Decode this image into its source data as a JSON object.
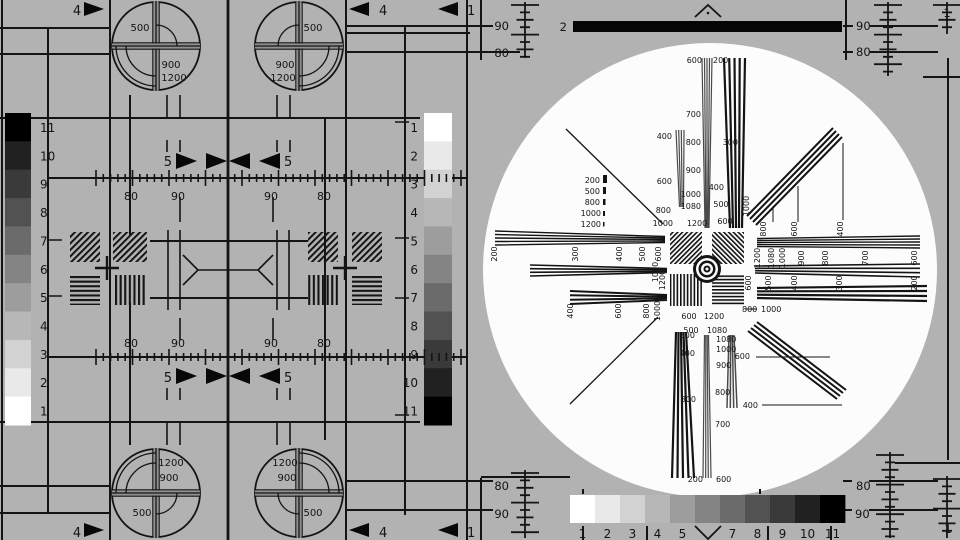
{
  "colors": {
    "background": "#b2b2b2",
    "line": "#141414",
    "white_disc": "#fcfcfc",
    "bar_black": "#050505",
    "gray_fan": "#4a4a4a"
  },
  "grayscale": {
    "steps_light_to_dark": [
      "#ffffff",
      "#e9e9e9",
      "#d2d2d2",
      "#b7b7b7",
      "#9d9d9d",
      "#848484",
      "#6b6b6b",
      "#525252",
      "#3a3a3a",
      "#212121",
      "#000000"
    ],
    "left_labels_top_to_bottom": [
      "11",
      "10",
      "9",
      "8",
      "7",
      "6",
      "5",
      "4",
      "3",
      "2",
      "1"
    ],
    "mid_labels_top_to_bottom": [
      "1",
      "2",
      "3",
      "4",
      "5",
      "6",
      "7",
      "8",
      "9",
      "10",
      "11"
    ],
    "bottom_labels_left_to_right": [
      "1",
      "2",
      "3",
      "4",
      "5",
      "",
      "7",
      "8",
      "9",
      "10",
      "11"
    ]
  },
  "labels": {
    "groups": [
      {
        "name": "corner-circle-labels",
        "size": 10,
        "items": [
          [
            140,
            31,
            "500"
          ],
          [
            171,
            68,
            "900"
          ],
          [
            174,
            81,
            "1200"
          ],
          [
            313,
            31,
            "500"
          ],
          [
            285,
            68,
            "900"
          ],
          [
            283,
            81,
            "1200"
          ],
          [
            171,
            466,
            "1200"
          ],
          [
            169,
            481,
            "900"
          ],
          [
            142,
            516,
            "500"
          ],
          [
            285,
            466,
            "1200"
          ],
          [
            287,
            481,
            "900"
          ],
          [
            313,
            516,
            "500"
          ]
        ]
      },
      {
        "name": "edge-percent-labels",
        "size": 11.5,
        "items": [
          [
            509,
            30,
            "90",
            "end"
          ],
          [
            509,
            57,
            "80",
            "end"
          ],
          [
            567,
            31,
            "2",
            "end"
          ],
          [
            856,
            30,
            "90",
            "start"
          ],
          [
            856,
            56,
            "80",
            "start"
          ],
          [
            947,
            17,
            "1"
          ],
          [
            509,
            490,
            "80",
            "end"
          ],
          [
            509,
            518,
            "90",
            "end"
          ],
          [
            856,
            490,
            "80",
            "start"
          ],
          [
            855,
            518,
            "90",
            "start"
          ],
          [
            948,
            533,
            "1"
          ]
        ]
      },
      {
        "name": "mid-ruler-labels",
        "size": 11,
        "items": [
          [
            131,
            200,
            "80"
          ],
          [
            178,
            200,
            "90"
          ],
          [
            271,
            200,
            "90"
          ],
          [
            324,
            200,
            "80"
          ],
          [
            131,
            347,
            "80"
          ],
          [
            178,
            347,
            "90"
          ],
          [
            271,
            347,
            "90"
          ],
          [
            324,
            347,
            "80"
          ]
        ]
      },
      {
        "name": "arrow-number-labels",
        "size": 13,
        "items": [
          [
            77,
            15,
            "4"
          ],
          [
            379,
            15,
            "4",
            "start"
          ],
          [
            467,
            15,
            "1",
            "start"
          ],
          [
            172,
            166,
            "5",
            "end"
          ],
          [
            284,
            166,
            "5",
            "start"
          ],
          [
            77,
            537,
            "4"
          ],
          [
            379,
            537,
            "4",
            "start"
          ],
          [
            467,
            537,
            "1",
            "start"
          ],
          [
            172,
            382,
            "5",
            "end"
          ],
          [
            284,
            382,
            "5",
            "start"
          ]
        ]
      },
      {
        "name": "resolution-labels-horizontal",
        "size": 8,
        "items": [
          [
            702,
            63,
            "600",
            "end"
          ],
          [
            713,
            63,
            "200",
            "start"
          ],
          [
            701,
            117,
            "700",
            "end"
          ],
          [
            701,
            145,
            "800",
            "end"
          ],
          [
            701,
            173,
            "900",
            "end"
          ],
          [
            701,
            197,
            "1000",
            "end"
          ],
          [
            701,
            209,
            "1080",
            "end"
          ],
          [
            672,
            139,
            "400",
            "end"
          ],
          [
            672,
            184,
            "600",
            "end"
          ],
          [
            671,
            213,
            "800",
            "end"
          ],
          [
            673,
            226,
            "1000",
            "end"
          ],
          [
            738,
            145,
            "300",
            "end"
          ],
          [
            724,
            190,
            "400",
            "end"
          ],
          [
            721,
            207,
            "500"
          ],
          [
            725,
            224,
            "600"
          ],
          [
            697,
            226,
            "1200"
          ],
          [
            689,
            319,
            "600"
          ],
          [
            714,
            319,
            "1200"
          ],
          [
            691,
            333,
            "500"
          ],
          [
            717,
            333,
            "1080"
          ],
          [
            742,
            312,
            "800",
            "start"
          ],
          [
            761,
            312,
            "1000",
            "start"
          ],
          [
            695,
            338,
            "500",
            "end"
          ],
          [
            695,
            356,
            "400",
            "end"
          ],
          [
            696,
            402,
            "300",
            "end"
          ],
          [
            703,
            482,
            "200",
            "end"
          ],
          [
            716,
            342,
            "1080",
            "start"
          ],
          [
            716,
            352,
            "1000",
            "start"
          ],
          [
            716,
            368,
            "900",
            "start"
          ],
          [
            715,
            395,
            "800",
            "start"
          ],
          [
            715,
            427,
            "700",
            "start"
          ],
          [
            716,
            482,
            "600",
            "start"
          ],
          [
            750,
            359,
            "600",
            "end"
          ],
          [
            758,
            408,
            "400",
            "end"
          ],
          [
            600,
            183,
            "200",
            "end"
          ],
          [
            600,
            194,
            "500",
            "end"
          ],
          [
            600,
            205,
            "800",
            "end"
          ],
          [
            601,
            216,
            "1000",
            "end"
          ],
          [
            601,
            227,
            "1200",
            "end"
          ]
        ]
      },
      {
        "name": "resolution-labels-rotated",
        "size": 8,
        "rot": true,
        "items": [
          [
            497,
            254,
            "200"
          ],
          [
            578,
            254,
            "300"
          ],
          [
            622,
            254,
            "400"
          ],
          [
            645,
            254,
            "500"
          ],
          [
            661,
            254,
            "600"
          ],
          [
            573,
            311,
            "400"
          ],
          [
            621,
            311,
            "600"
          ],
          [
            649,
            311,
            "800"
          ],
          [
            660,
            311,
            "1000"
          ],
          [
            658,
            272,
            "1080"
          ],
          [
            665,
            280,
            "1200"
          ],
          [
            760,
            258,
            "1200"
          ],
          [
            774,
            258,
            "1080"
          ],
          [
            785,
            258,
            "1000"
          ],
          [
            804,
            258,
            "900"
          ],
          [
            828,
            258,
            "800"
          ],
          [
            868,
            258,
            "700"
          ],
          [
            917,
            258,
            "600"
          ],
          [
            751,
            283,
            "600"
          ],
          [
            771,
            283,
            "500"
          ],
          [
            797,
            283,
            "400"
          ],
          [
            842,
            283,
            "300"
          ],
          [
            917,
            283,
            "200"
          ],
          [
            749,
            206,
            "1000"
          ],
          [
            766,
            229,
            "800"
          ],
          [
            797,
            229,
            "600"
          ],
          [
            843,
            229,
            "400"
          ]
        ]
      }
    ]
  }
}
